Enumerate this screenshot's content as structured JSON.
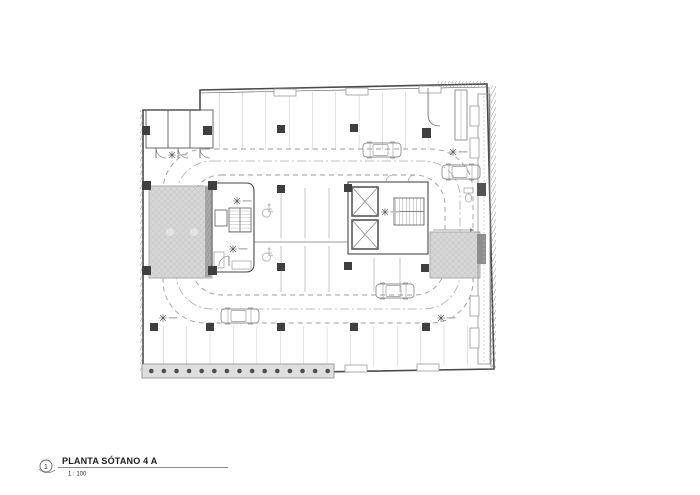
{
  "title_block": {
    "sheet_number": "1",
    "title": "PLANTA SÓTANO 4 A",
    "scale": "1 : 100"
  },
  "plan": {
    "kind": "basement parking garage floor plan",
    "features": [
      "parking stalls",
      "dashed driving lane loop",
      "vehicle ramps (hatched)",
      "elevator core",
      "two staircases",
      "accessible parking stalls",
      "parked vehicles",
      "pile retaining wall with bored piles",
      "perimeter ventilation shaft"
    ],
    "counts": {
      "cars": 4,
      "accessible_stalls": 2,
      "elevators": 2,
      "stairs": 2,
      "ramps": 2,
      "level_markers": 7
    }
  },
  "colors": {
    "paper": "#ffffff",
    "wall_line": "#474747",
    "light_line": "#b3b3b3",
    "lane_dash": "#9c9c9c",
    "ramp_fill": "#d6d6d6",
    "column_fill": "#3f3f3f",
    "pile_band": "#dedede"
  }
}
